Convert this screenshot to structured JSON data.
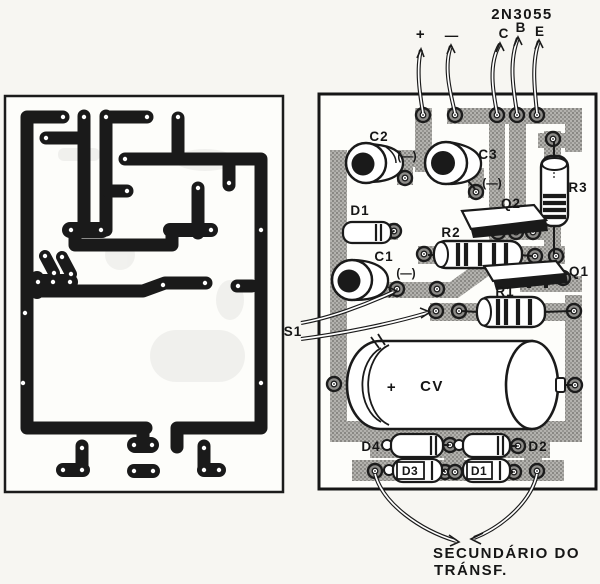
{
  "labels": {
    "transistor": "2N3055",
    "pin_c": "C",
    "pin_b": "B",
    "pin_e": "E",
    "plus": "+",
    "minus": "—",
    "c1": "C1",
    "c2": "C2",
    "c3": "C3",
    "c1_pol": "(—)",
    "c2_pol": "(—)",
    "c3_pol": "(—)",
    "cv": "CV",
    "cv_plus": "+",
    "d1_top": "D1",
    "d2": "D2",
    "d3": "D3",
    "d4": "D4",
    "d1_body": "D1",
    "d3_body": "D3",
    "q1": "Q1",
    "q2": "Q2",
    "r1": "R1",
    "r2": "R2",
    "r3": "R3",
    "s1": "S1",
    "caption_line1": "SECUNDÁRIO  DO",
    "caption_line2": "TRÁNSF."
  },
  "colors": {
    "trace_black": "#1a1a1a",
    "trace_gray": "#a7a6a2",
    "board": "#fdfdfa",
    "paper": "#f7f6f2",
    "pad_ring": "#8e8d8a"
  }
}
